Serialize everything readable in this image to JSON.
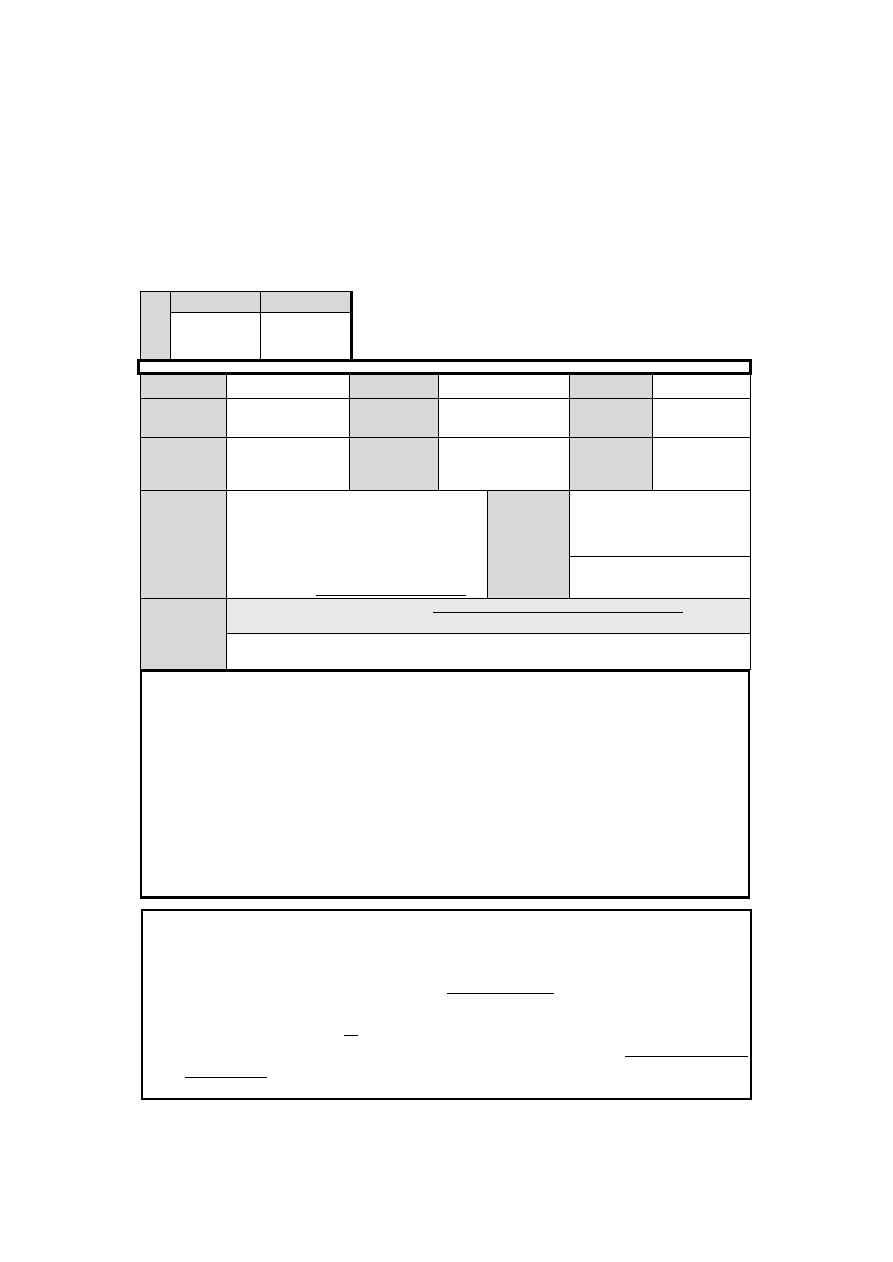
{
  "document": {
    "kind": "blank form page",
    "visible_text": "",
    "colors": {
      "page_background": "#ffffff",
      "cell_shading": "#d8d8d8",
      "banner_shading": "#e8e8e8",
      "line_color": "#000000"
    },
    "header_table": {
      "side_cell": "",
      "column1_header": "",
      "column2_header": "",
      "column1_value": "",
      "column2_value": ""
    },
    "title_banner": {
      "text": ""
    },
    "details_table": {
      "row4_fill_line": "",
      "row5_fill_line": ""
    },
    "notes_box": {
      "content": ""
    },
    "footer_box": {
      "line1": "",
      "line2": "",
      "line3": "",
      "line4": ""
    }
  }
}
